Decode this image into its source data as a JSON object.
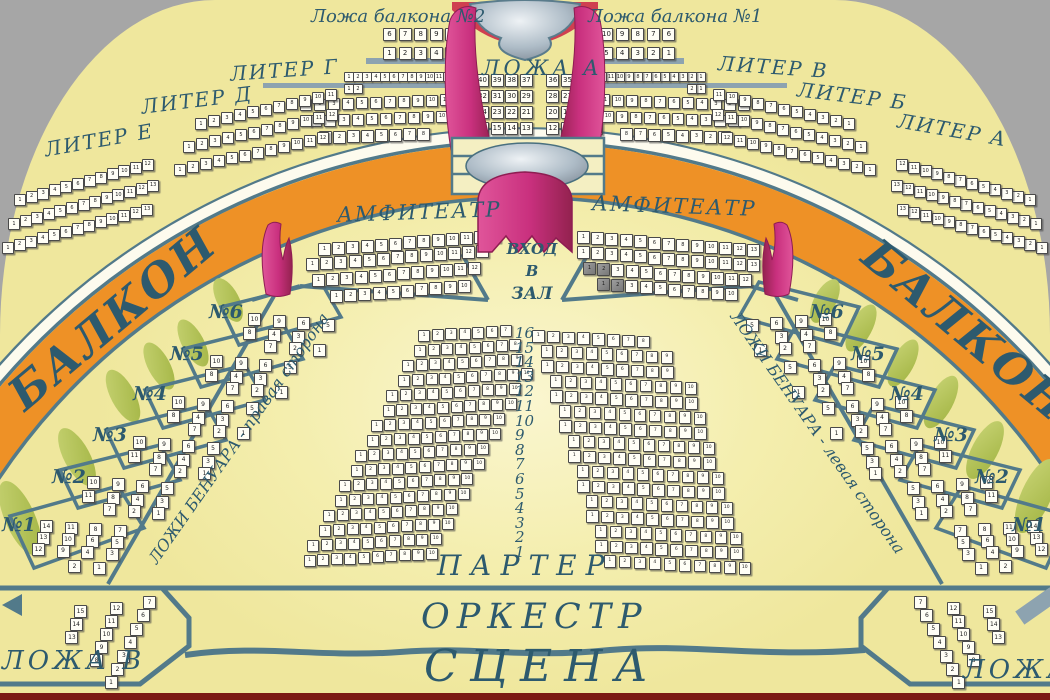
{
  "labels": {
    "balcony_box_2": "Ложа балкона №2",
    "balcony_box_1": "Ложа балкона №1",
    "loja_a": "ЛОЖА А",
    "liter_g": "ЛИТЕР Г",
    "liter_d": "ЛИТЕР Д",
    "liter_e": "ЛИТЕР Е",
    "liter_v": "ЛИТЕР В",
    "liter_b": "ЛИТЕР Б",
    "liter_a": "ЛИТЕР А",
    "balkon": "БАЛКОН",
    "amfiteatr": "АМФИТЕАТР",
    "vhod_line1": "ВХОД",
    "vhod_line2": "В",
    "vhod_line3": "ЗАЛ",
    "benoir_right_text": "ЛОЖИ БЕНУАРА - правая сторона",
    "benoir_left_text": "ЛОЖИ БЕНУАРА - левая сторона",
    "parter": "ПАРТЕР",
    "orkestr": "ОРКЕСТР",
    "scena": "СЦЕНА",
    "loja_v": "ЛОЖА В",
    "loja_b": "ЛОЖА"
  },
  "benoir_numbers": [
    "№1",
    "№2",
    "№3",
    "№4",
    "№5",
    "№6"
  ],
  "parter_row_numbers": [
    "16",
    "15",
    "14",
    "13",
    "12",
    "11",
    "10",
    "9",
    "8",
    "7",
    "6",
    "5",
    "4",
    "3",
    "2",
    "1"
  ],
  "colors": {
    "background": "#a6a6a6",
    "hall": "#f2ecA3",
    "balcony_band": "#ee9126",
    "structure_lines": "#527a8a",
    "label_text": "#2d5a6e",
    "curtain": "#c9307e",
    "seat": "#fffef6",
    "seat_unavailable": "#898989",
    "foliage": "#b8c75f",
    "bottom_strip": "#7c1a13"
  },
  "seat_blocks": {
    "lozha_balkona_2": {
      "rows": [
        [
          6,
          7,
          8,
          9,
          10
        ],
        [
          1,
          2,
          3,
          4,
          5
        ]
      ]
    },
    "lozha_balkona_1": {
      "rows": [
        [
          10,
          9,
          8,
          7,
          6
        ],
        [
          5,
          4,
          3,
          2,
          1
        ]
      ]
    },
    "lozha_a": {
      "rows": [
        [
          40,
          39,
          38,
          37,
          36,
          35,
          34,
          33
        ],
        [
          32,
          31,
          30,
          29,
          28,
          27,
          26,
          25
        ],
        [
          24,
          23,
          22,
          21,
          20,
          19,
          18,
          17
        ],
        [
          16,
          15,
          14,
          13,
          12,
          11,
          10,
          9
        ],
        [
          8,
          7,
          6,
          5,
          4,
          3,
          2,
          1
        ]
      ]
    },
    "liter_g": {
      "row_counts": [
        12,
        2,
        11,
        10,
        8
      ]
    },
    "liter_v": {
      "row_counts": [
        12,
        2,
        11,
        10,
        8
      ]
    },
    "liter_d": {
      "row_counts": [
        11,
        12,
        12
      ]
    },
    "liter_b": {
      "row_counts": [
        11,
        12,
        12
      ]
    },
    "liter_e": {
      "row_counts": [
        12,
        13,
        13
      ]
    },
    "liter_a": {
      "row_counts": [
        12,
        13,
        13
      ]
    },
    "amfiteatr_left": {
      "row_counts": [
        13,
        13,
        12,
        10
      ]
    },
    "amfiteatr_right": {
      "row_counts": [
        13,
        13,
        12,
        10
      ],
      "dark_seats": [
        [
          2,
          0
        ],
        [
          2,
          1
        ],
        [
          3,
          0
        ],
        [
          3,
          1
        ]
      ]
    },
    "parter_left": {
      "row_counts_top_to_bottom": [
        7,
        8,
        9,
        10,
        10,
        10,
        10,
        10,
        10,
        10,
        10,
        10,
        10,
        10,
        10,
        10
      ]
    },
    "parter_right": {
      "row_counts_top_to_bottom": [
        8,
        9,
        9,
        10,
        10,
        10,
        10,
        10,
        10,
        10,
        10,
        10,
        10,
        10,
        10,
        10
      ]
    },
    "benoir_left": {
      "boxes": [
        {
          "label": "№1",
          "rows": [
            [
              14,
              11,
              8,
              7
            ],
            [
              13,
              10,
              6,
              5
            ],
            [
              12,
              9,
              4,
              3
            ],
            [
              2,
              1
            ]
          ]
        },
        {
          "label": "№2",
          "rows": [
            [
              10,
              9,
              6,
              5
            ],
            [
              11,
              8,
              4,
              3
            ],
            [
              7,
              2,
              1
            ]
          ]
        },
        {
          "label": "№3",
          "rows": [
            [
              10,
              9,
              6,
              5
            ],
            [
              11,
              8,
              4,
              3
            ],
            [
              7,
              2,
              1
            ]
          ]
        },
        {
          "label": "№4",
          "rows": [
            [
              10,
              9,
              6,
              5
            ],
            [
              8,
              4,
              3
            ],
            [
              7,
              2,
              1
            ]
          ]
        },
        {
          "label": "№5",
          "rows": [
            [
              10,
              9,
              6,
              5
            ],
            [
              8,
              4,
              3
            ],
            [
              7,
              2,
              1
            ]
          ]
        },
        {
          "label": "№6",
          "rows": [
            [
              10,
              9,
              6,
              5
            ],
            [
              8,
              4,
              3
            ],
            [
              7,
              2,
              1
            ]
          ]
        }
      ]
    },
    "benoir_right": {
      "boxes": [
        {
          "label": "№1",
          "rows": [
            [
              14,
              11,
              8,
              7
            ],
            [
              13,
              10,
              6,
              5
            ],
            [
              12,
              9,
              4,
              3
            ],
            [
              2,
              1
            ]
          ]
        },
        {
          "label": "№2",
          "rows": [
            [
              10,
              9,
              6,
              5
            ],
            [
              11,
              8,
              4,
              3
            ],
            [
              7,
              2,
              1
            ]
          ]
        },
        {
          "label": "№3",
          "rows": [
            [
              10,
              9,
              6,
              5
            ],
            [
              11,
              8,
              4,
              3
            ],
            [
              7,
              2,
              1
            ]
          ]
        },
        {
          "label": "№4",
          "rows": [
            [
              10,
              9,
              6,
              5
            ],
            [
              8,
              4,
              3
            ],
            [
              7,
              2,
              1
            ]
          ]
        },
        {
          "label": "№5",
          "rows": [
            [
              10,
              9,
              6,
              5
            ],
            [
              8,
              4,
              3
            ],
            [
              7,
              2,
              1
            ]
          ]
        },
        {
          "label": "№6",
          "rows": [
            [
              10,
              9,
              6,
              5
            ],
            [
              8,
              4,
              3
            ],
            [
              7,
              2,
              1
            ]
          ]
        }
      ]
    },
    "lozha_v": {
      "rows": [
        [
          15,
          14,
          13
        ],
        [
          12,
          11,
          10,
          9,
          8
        ],
        [
          7,
          6,
          5,
          4,
          3,
          2,
          1
        ]
      ]
    },
    "lozha_b": {
      "rows": [
        [
          15,
          14,
          13
        ],
        [
          12,
          11,
          10,
          9,
          8
        ],
        [
          7,
          6,
          5,
          4,
          3,
          2,
          1
        ]
      ]
    }
  }
}
